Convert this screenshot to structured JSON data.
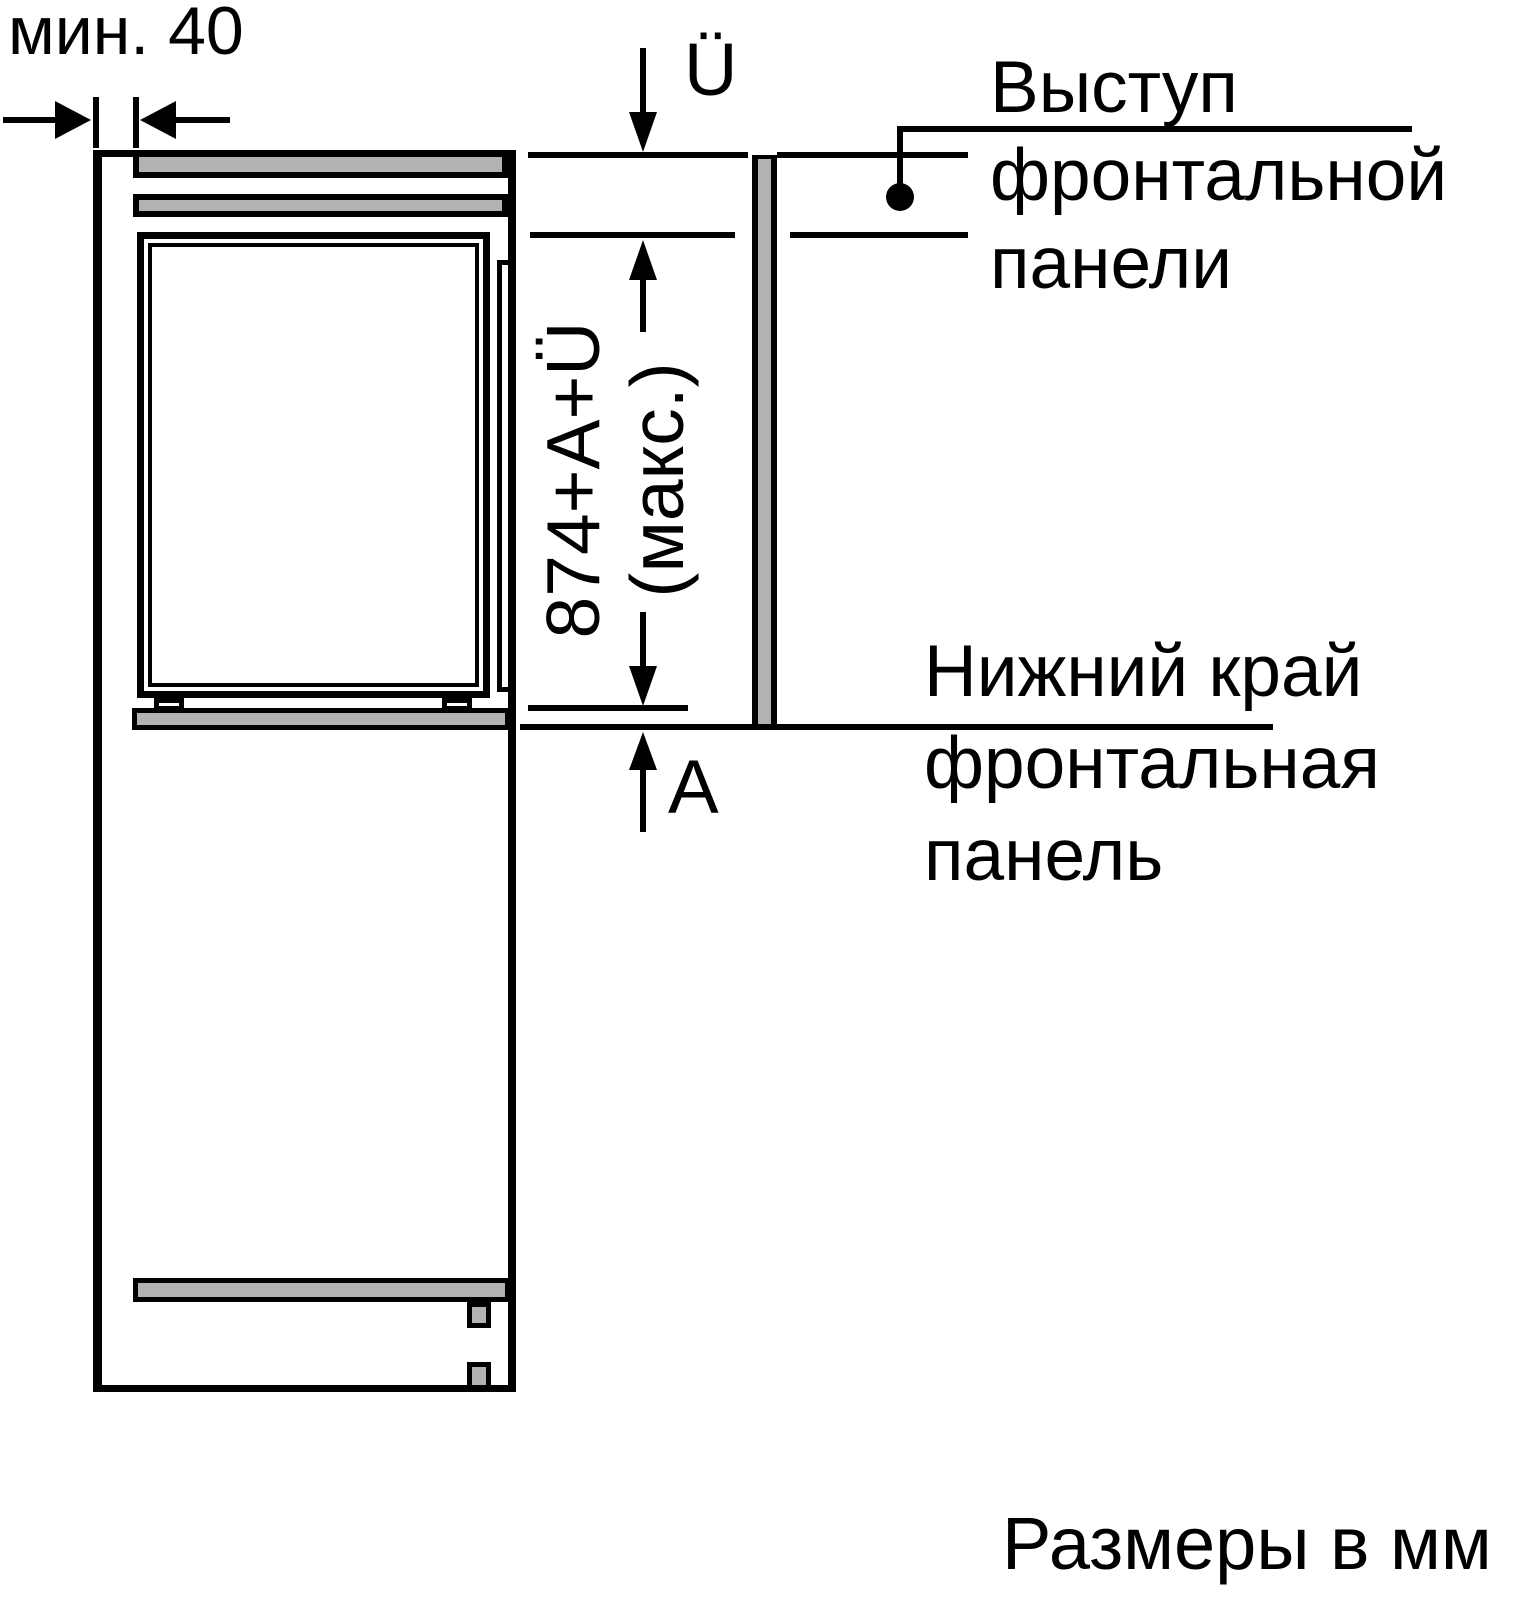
{
  "title": "Built-in appliance niche installation diagram",
  "units_note": "Размеры в мм",
  "dimensions": {
    "min_gap": "мин. 40",
    "overhang": "Ü",
    "max_height": "874+A+Ü\n(макс.)",
    "plinth_height": "A"
  },
  "callouts": {
    "front_panel_overhang": "Выступ\nфронтальной\nпанели",
    "front_panel_lower_edge": "Нижний край\nфронтальная\nпанель"
  },
  "colors": {
    "line": "#000000",
    "panel_gray": "#b2b2b2",
    "background": "#ffffff"
  }
}
